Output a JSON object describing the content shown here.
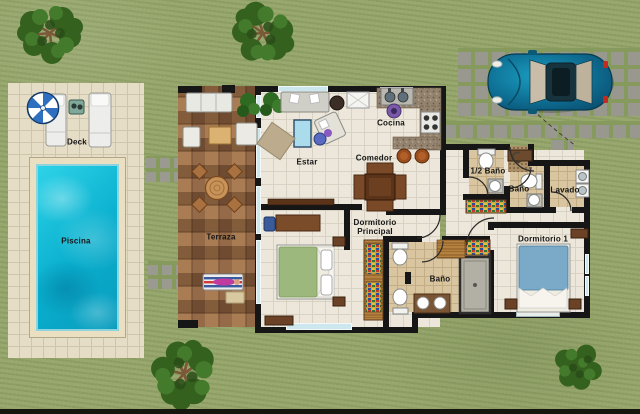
{
  "title": "Residential site floor plan",
  "rooms": {
    "deck": "Deck",
    "piscina": "Piscina",
    "terraza": "Terraza",
    "estar": "Estar",
    "comedor": "Comedor",
    "cocina": "Cocina",
    "half_bath": "1/2 Baño",
    "bath_top": "Baño",
    "lavado": "Lavado",
    "dorm_principal": "Dormitorio Principal",
    "bath_main": "Baño",
    "dorm_1": "Dormitorio 1"
  },
  "objects": {
    "pool": "swimming pool",
    "umbrella": "blue-white parasol",
    "loungers": "two white sun loungers",
    "car": "teal car on paver driveway",
    "trees": "four green trees",
    "beds": "green double bed, blue double bed",
    "dining_table": "dark wood cross-shaped table",
    "appliances": "fridge, sink, stove, washer-dryer"
  },
  "colors": {
    "grass": "#98a76e",
    "deck_tile": "#e6ddc7",
    "pool_water": "#0fb5d4",
    "terrace_tile": "#8a5f3c",
    "wall": "#161616",
    "floor_tile": "#ece7da",
    "bath_tile": "#d9c6a0",
    "window": "#cde7ef",
    "car_body": "#0f7ca0",
    "tree_foliage": "#35611f",
    "paver": "#98988e"
  }
}
